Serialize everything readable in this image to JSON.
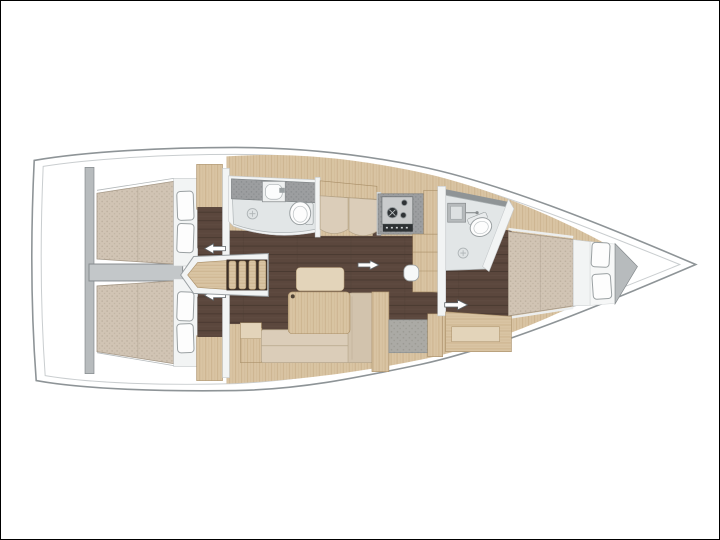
{
  "meta": {
    "type": "floorplan-diagram",
    "label": "sailing-yacht-interior-layout-top-view"
  },
  "palette": {
    "deck": "#ffffff",
    "hull_line": "#8e9497",
    "hull_inner_line": "#c9cdcf",
    "wall": "#b7bbbd",
    "wall_line": "#84898c",
    "wall_white": "#f2f4f4",
    "floor": "#5b473d",
    "floor_line": "#4a3a31",
    "wood": "#d9c4a3",
    "wood_line": "#b4946a",
    "wood_edge": "#a98f68",
    "wood_light": "#e3d4ba",
    "mattress": "#d1c4b4",
    "mattress_dot": "#bcaf9e",
    "mattress_edge": "#a79a89",
    "counter": "#9c9ea0",
    "counter_dot": "#85888a",
    "bath": "#e2e6e7",
    "fixture_line": "#9aa0a2",
    "stove_panel": "#c9cbcc",
    "stove_burner": "#2f3336",
    "seat_gray": "#abaaa5",
    "seat_gray_dot": "#97968f",
    "cushion": "#dbcdb9",
    "cushion_dark": "#d2c3ad",
    "cushion_line": "#b7a78c",
    "pillow": "#fdfdfd",
    "pillow_line": "#9aa0a2"
  },
  "regions": [
    {
      "id": "aft-cabin-upper",
      "label": "aft-double-berth-cabin"
    },
    {
      "id": "aft-cabin-lower",
      "label": "aft-double-berth-cabin"
    },
    {
      "id": "engine-corridor",
      "label": "engine-compartment-corridor"
    },
    {
      "id": "companionway-stairs",
      "label": "companionway-steps"
    },
    {
      "id": "aft-head",
      "label": "bathroom-with-sink-and-toilet"
    },
    {
      "id": "settee",
      "label": "two-seat-settee"
    },
    {
      "id": "salon",
      "label": "saloon-with-table-and-l-sofa"
    },
    {
      "id": "galley",
      "label": "galley-with-two-burner-stove"
    },
    {
      "id": "forward-head",
      "label": "bathroom-with-shower-and-toilet"
    },
    {
      "id": "forward-cabin",
      "label": "forward-double-berth-cabin"
    },
    {
      "id": "bow",
      "label": "bow-tip"
    }
  ],
  "fixtures": [
    "double-berth",
    "pillows",
    "toilet",
    "sink",
    "shower-mixer",
    "floor-drain",
    "stove-2-burner",
    "oven",
    "saloon-table",
    "l-shaped-sofa",
    "chart-seat",
    "wardrobe",
    "sliding-door-arrows"
  ]
}
